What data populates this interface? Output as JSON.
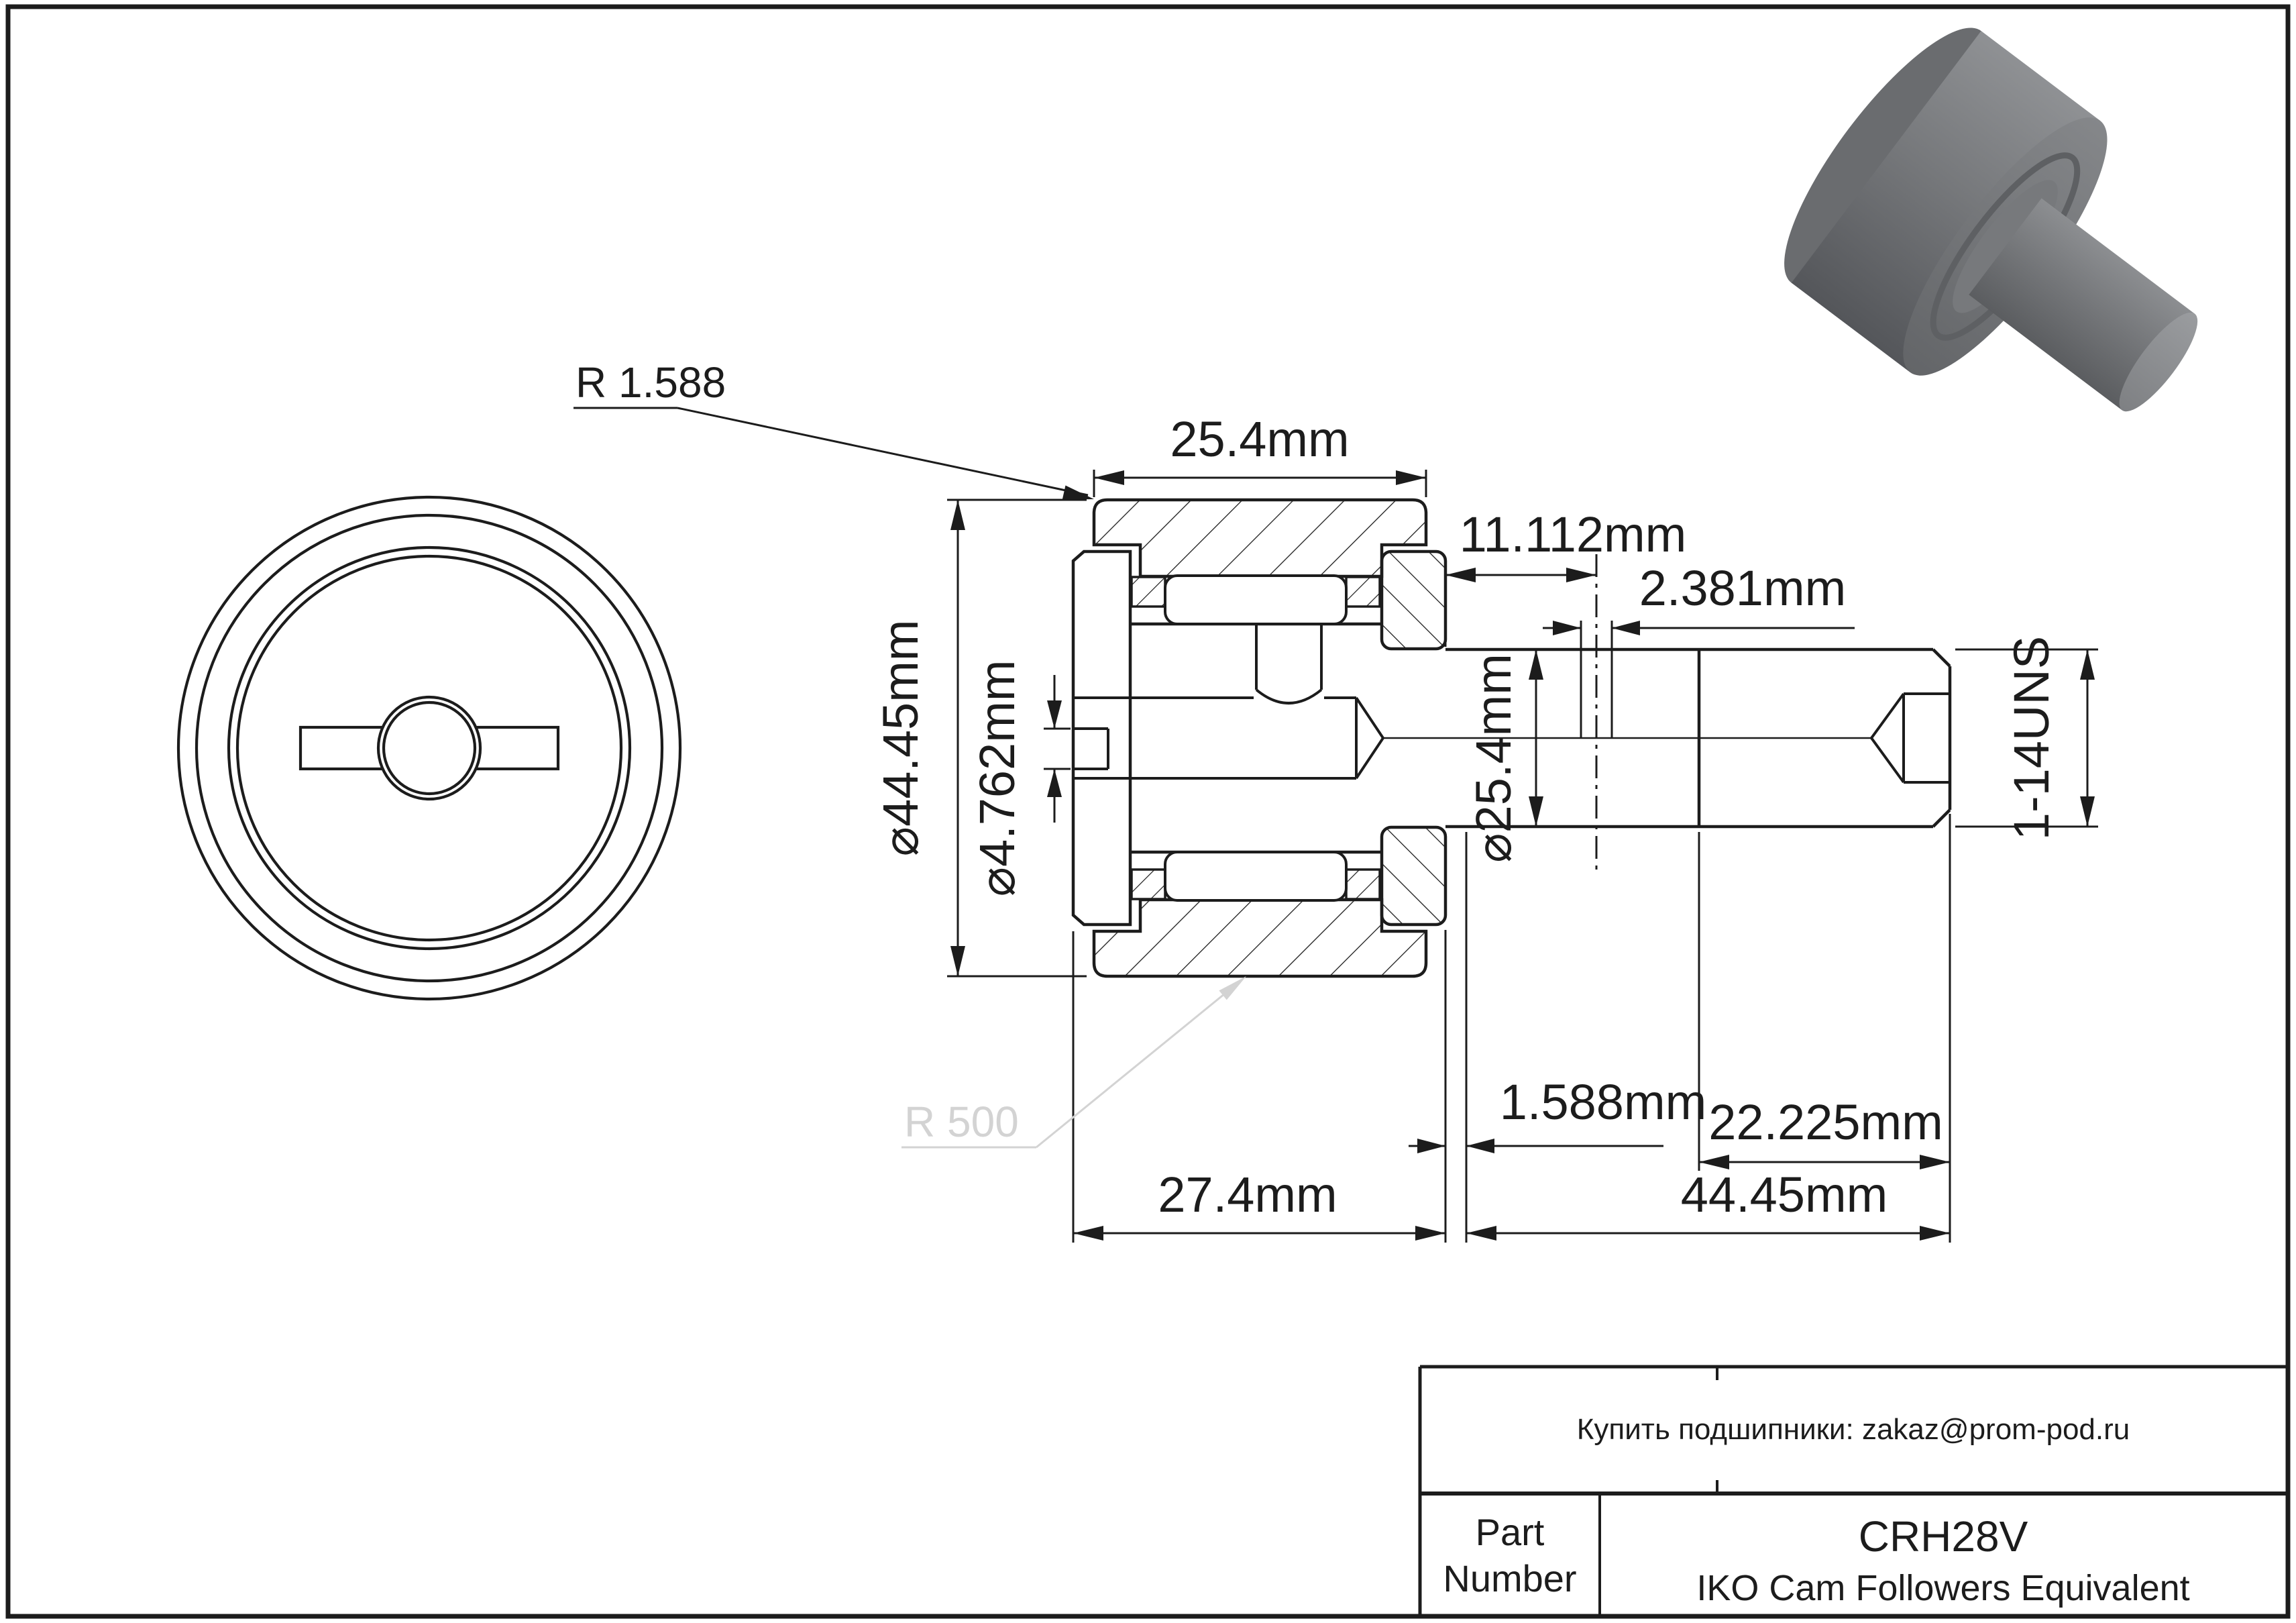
{
  "sheet": {
    "background": "#ffffff",
    "line_color": "#1c1c1c",
    "muted_color": "#d3d3d3",
    "render_gray": "#77797c"
  },
  "section": {
    "labels": {
      "corner_radius": "R 1.588",
      "roller_width": "25.4mm",
      "grease_hole_offset": "11.112mm",
      "grease_hole_diameter": "2.381mm",
      "roller_outer_diameter": "⌀44.45mm",
      "slot_width": "⌀4.762mm",
      "stud_diameter": "⌀25.4mm",
      "thread_spec": "1-14UNS",
      "thread_length": "22.225mm",
      "flange_offset": "1.588mm",
      "head_width": "27.4mm",
      "stud_length": "44.45mm",
      "crown_radius": "R 500"
    }
  },
  "title_block": {
    "contact": "Купить подшипники: zakaz@prom-pod.ru",
    "part_label_line1": "Part",
    "part_label_line2": "Number",
    "part_number": "CRH28V",
    "description": "IKO Cam Followers Equivalent"
  }
}
